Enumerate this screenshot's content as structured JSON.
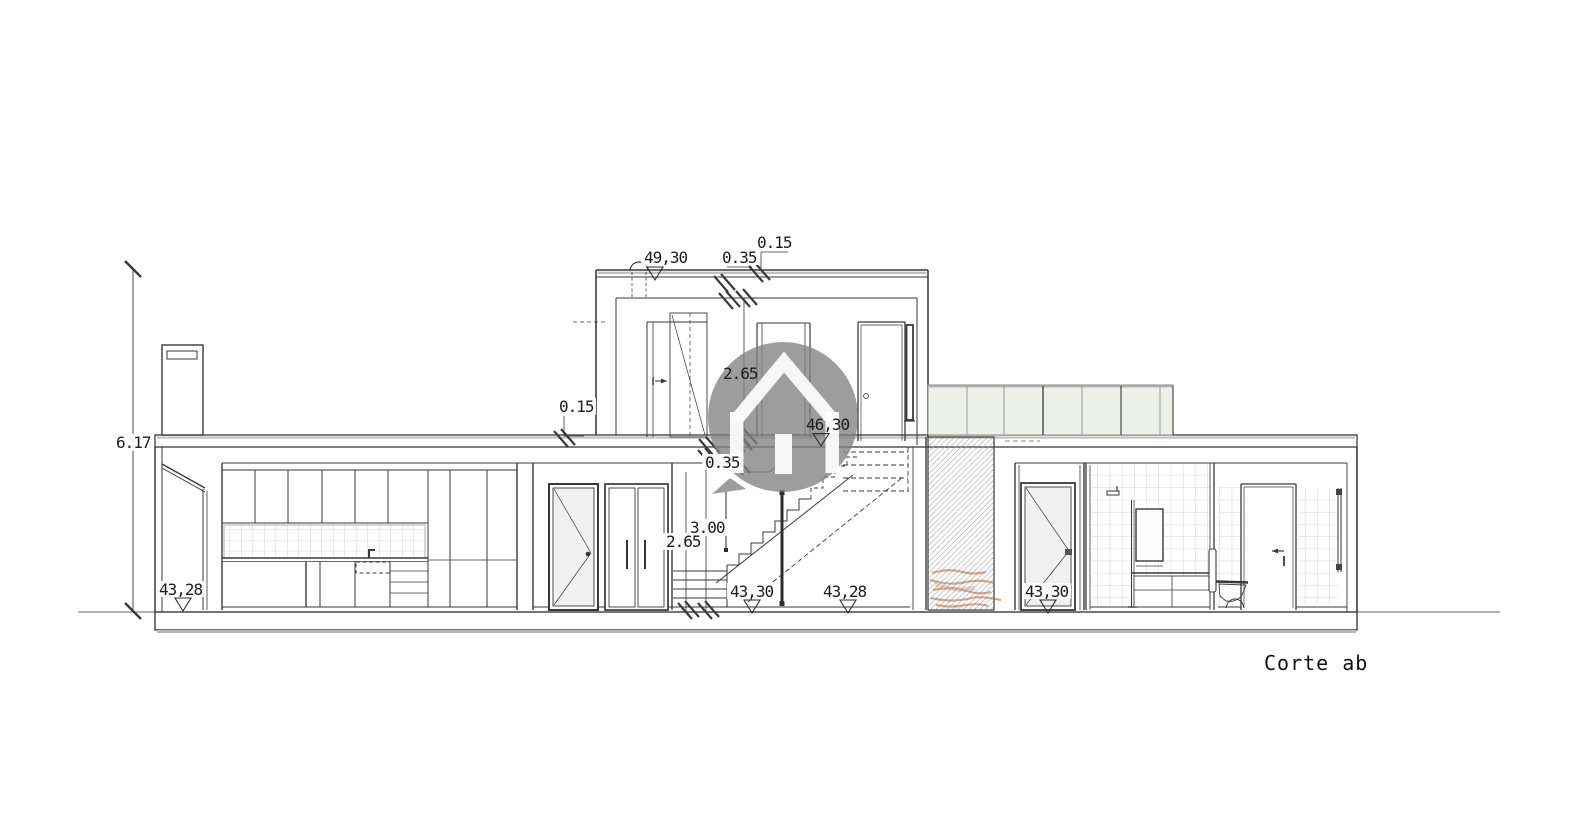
{
  "page": {
    "background": "#ffffff",
    "type": "architectural-section-drawing"
  },
  "title_block": {
    "text": "Corte ab"
  },
  "dimension_labels": [
    {
      "id": "total-height",
      "text": "6.17"
    },
    {
      "id": "parapet-top",
      "text": "0.15"
    },
    {
      "id": "roof-edge",
      "text": "0.35"
    },
    {
      "id": "upper-room-height",
      "text": "2.65"
    },
    {
      "id": "left-slab-thickness",
      "text": "0.15"
    },
    {
      "id": "stair-slab-edge",
      "text": "0.35"
    },
    {
      "id": "ground-floor-height",
      "text": "3.00"
    },
    {
      "id": "ground-clear-height",
      "text": "2.65"
    }
  ],
  "level_markers": [
    {
      "id": "roof-level",
      "text": "49,30"
    },
    {
      "id": "upper-floor-level",
      "text": "46,30"
    },
    {
      "id": "porch-ground-level",
      "text": "43,28"
    },
    {
      "id": "stair-ground-level",
      "text": "43,30"
    },
    {
      "id": "ground-right-of-stair",
      "text": "43,28"
    },
    {
      "id": "vestibule-ground-level",
      "text": "43,30"
    }
  ],
  "symbols": {
    "elevation_marker": "open-triangle-down",
    "dimension_tick": "diagonal-slash",
    "watermark": "house-in-speech-bubble"
  },
  "colors": {
    "line": "#3a3a3a",
    "shadow_gray": "#bdbdbd",
    "tile_grid": "#c9c9c9",
    "glass": "#f1f1f1",
    "railing_glass": "#edf1ea",
    "watermark_gray": "#828282",
    "red_marks": "#a8562e"
  }
}
